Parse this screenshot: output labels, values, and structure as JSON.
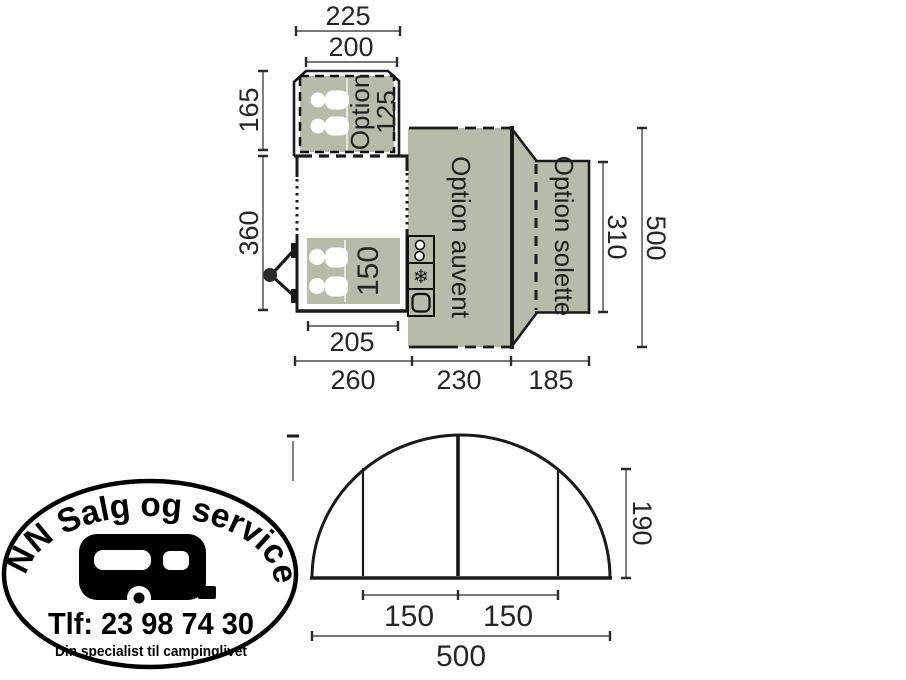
{
  "floorplan": {
    "annex": {
      "dim_outer": "225",
      "dim_inner": "200",
      "dim_depth": "165",
      "option_line1": "Option",
      "option_line2": "125"
    },
    "caravan": {
      "dim_length": "360",
      "dim_total_length": "260",
      "bed_label": "150",
      "bed_dim": "205"
    },
    "awning": {
      "label": "Option auvent",
      "dim_width": "230",
      "dim_total_height": "500"
    },
    "solette": {
      "label": "Option solette",
      "dim_width": "185",
      "dim_height": "310"
    },
    "icons": {
      "fridge_glyph": "❄"
    }
  },
  "elevation": {
    "dim_panel_left": "150",
    "dim_panel_right": "150",
    "dim_total_width": "500",
    "dim_height": "190"
  },
  "logo": {
    "arc_text": "NN Salg og service",
    "phone": "Tlf: 23 98 74 30",
    "tagline": "Din specialist til campinglivet"
  },
  "colors": {
    "area_fill": "#b7bbaa",
    "outline": "#1a1a1a",
    "dimension": "#4a4a4a"
  }
}
